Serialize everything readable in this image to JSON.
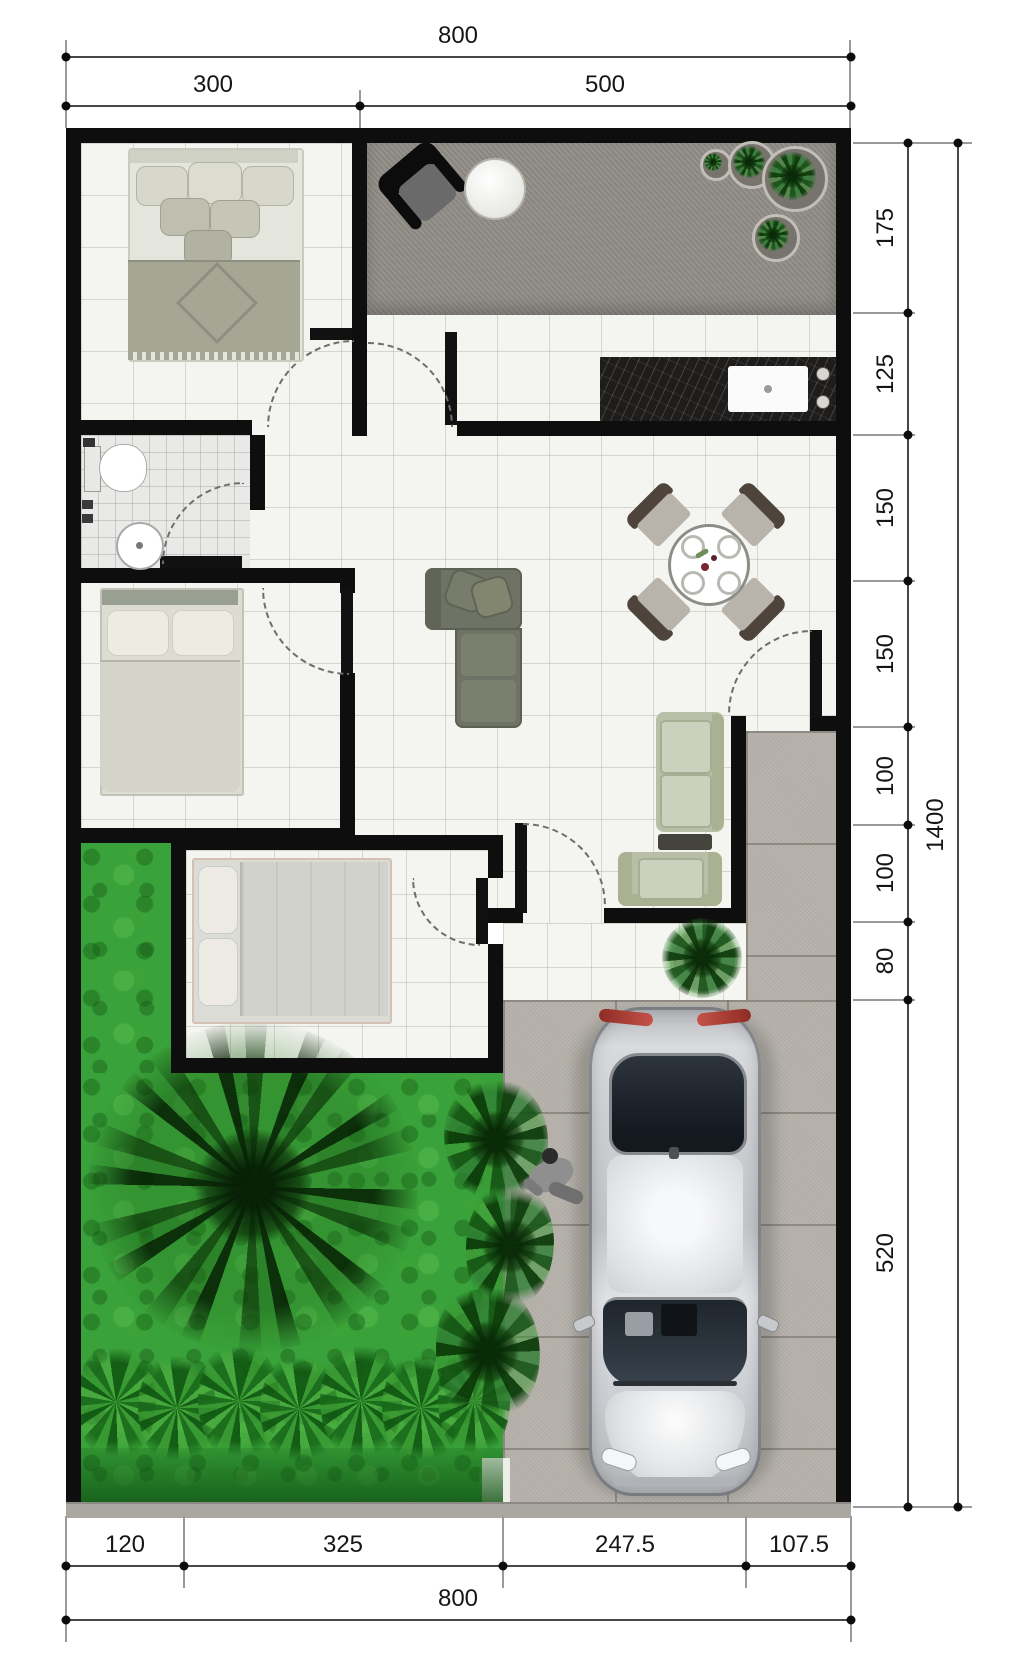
{
  "plan": {
    "type": "house-floor-plan-top-view",
    "dimensions": {
      "top": {
        "total": "800",
        "segments": [
          "300",
          "500"
        ]
      },
      "right": {
        "total": "1400",
        "segments": [
          "175",
          "125",
          "150",
          "150",
          "100",
          "100",
          "80",
          "520"
        ]
      },
      "bottom": {
        "total": "800",
        "segments": [
          "120",
          "325",
          "247.5",
          "107.5"
        ]
      }
    },
    "colors": {
      "wall": "#0e0e0e",
      "grass": "#3aa23a",
      "paving": "#b6b2ab",
      "terrace": "#908c86",
      "kitchen_counter": "#1f1d1c",
      "car_body": "#d6d8db",
      "taillight_red": "#a93a30",
      "sofa_dark": "#6f7365",
      "sofa_sage": "#ccd1bd",
      "dimension_text": "#161616"
    },
    "furniture_icons": [
      "double-bed",
      "single-bed",
      "toilet",
      "washbasin",
      "kitchen-counter-sink",
      "dining-table-4-chairs",
      "l-shaped-sofa",
      "sofa-set-coffee-table",
      "terrace-chair-table",
      "potted-plants",
      "palm-tree",
      "garden-bushes",
      "car-top-view",
      "person-figure"
    ]
  }
}
